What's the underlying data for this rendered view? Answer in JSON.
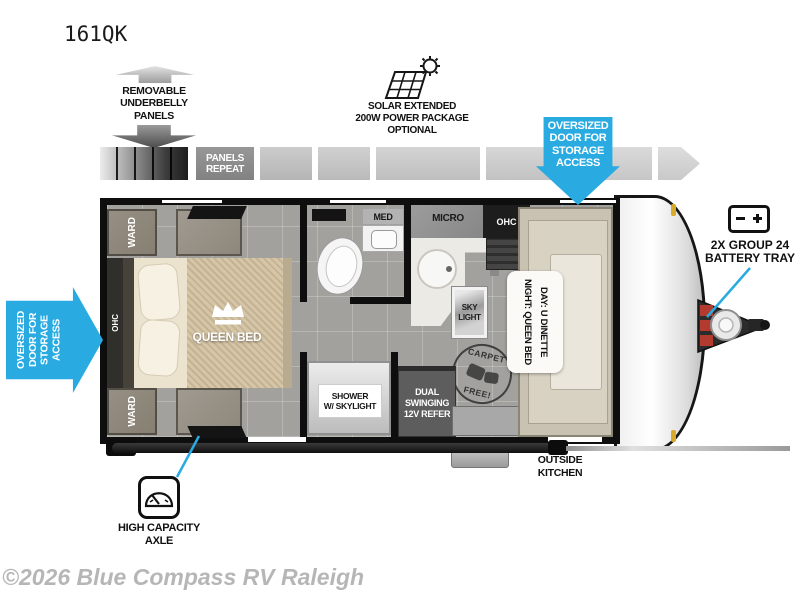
{
  "title": "161QK",
  "watermark": "©2026 Blue Compass RV Raleigh",
  "colors": {
    "accent": "#29abe2"
  },
  "callouts": {
    "underbelly": "REMOVABLE\nUNDERBELLY\nPANELS",
    "panels_repeat": "PANELS\nREPEAT",
    "solar": "SOLAR EXTENDED\n200W POWER PACKAGE\nOPTIONAL",
    "storage_door_top": "OVERSIZED\nDOOR FOR\nSTORAGE\nACCESS",
    "storage_door_left": "OVERSIZED\nDOOR FOR\nSTORAGE\nACCESS",
    "battery_tray": "2X GROUP 24\nBATTERY TRAY",
    "high_capacity_axle": "HIGH CAPACITY\nAXLE",
    "outside_kitchen": "OUTSIDE\nKITCHEN"
  },
  "rooms": {
    "ward_top": "WARD",
    "ward_bottom": "WARD",
    "ohc_bedroom": "OHC",
    "queen_bed": "QUEEN BED",
    "med": "MED",
    "micro": "MICRO",
    "ohc_kitchen": "OHC",
    "skylight": "SKY\nLIGHT",
    "dinette": "DAY: U DINETTE\nNIGHT: QUEEN BED",
    "shower": "SHOWER\nW/ SKYLIGHT",
    "refer": "DUAL SWINGING\n12V REFER",
    "carpet_free_top": "CARPET",
    "carpet_free_bottom": "FREE!"
  }
}
